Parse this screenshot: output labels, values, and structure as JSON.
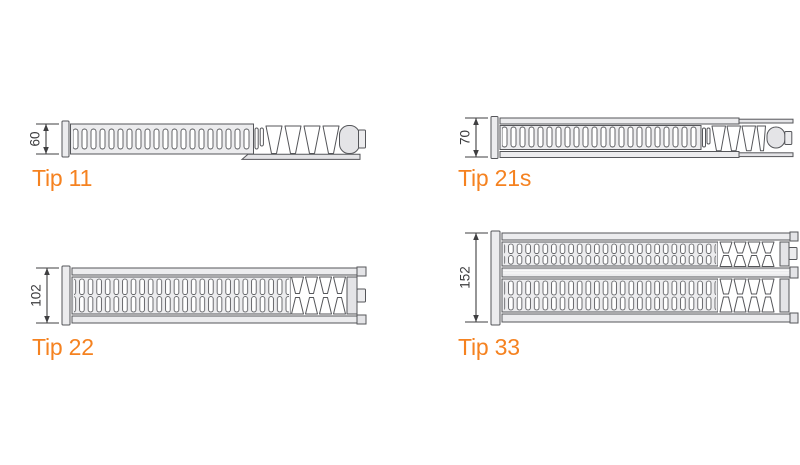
{
  "diagram": {
    "kind": "radiator-type-cross-sections",
    "colors": {
      "accent_orange": "#F58220",
      "artwork_outline": "#55565A",
      "artwork_fill": "#ECECEE",
      "dimension_line": "#3F3F41",
      "background": "#FFFFFF"
    },
    "radiators": [
      {
        "type_label": "Tip 11",
        "depth": "60"
      },
      {
        "type_label": "Tip 21s",
        "depth": "70"
      },
      {
        "type_label": "Tip 22",
        "depth": "102"
      },
      {
        "type_label": "Tip 33",
        "depth": "152"
      }
    ]
  }
}
